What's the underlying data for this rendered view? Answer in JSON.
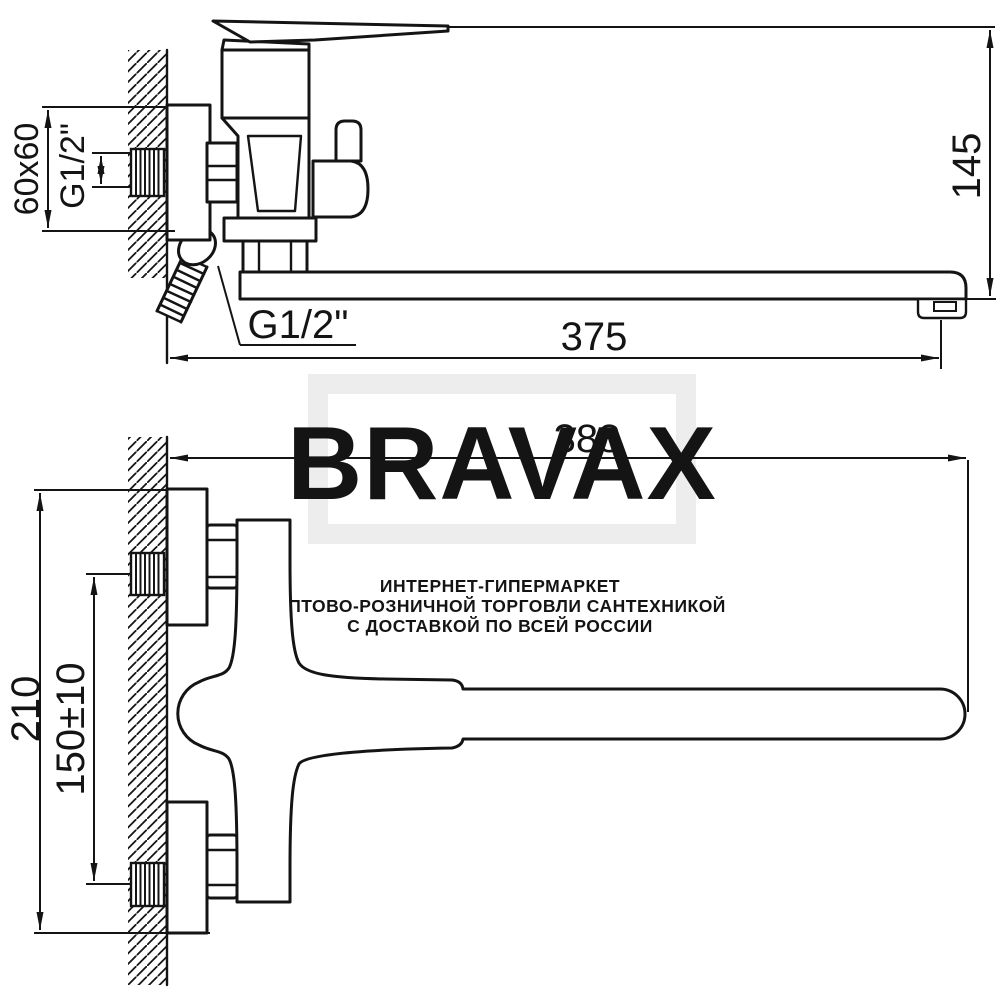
{
  "page": {
    "background": "#ffffff",
    "line_color": "#141414"
  },
  "watermark": {
    "brand": "BRAVAX",
    "brand_color": "#ededed",
    "frame_color": "#ededed",
    "tagline_color": "#e9e9e9",
    "tagline": [
      "ИНТЕРНЕТ-ГИПЕРМАРКЕТ",
      "ОПТОВО-РОЗНИЧНОЙ ТОРГОВЛИ САНТЕХНИКОЙ",
      "С ДОСТАВКОЙ ПО ВСЕЙ РОССИИ"
    ]
  },
  "side_view": {
    "dim_wall_plate": "60x60",
    "dim_inlet_thread": "G1/2\"",
    "dim_height": "145",
    "dim_spout_reach": "375",
    "dim_shower_thread": "G1/2\""
  },
  "front_view": {
    "dim_width": "388",
    "dim_height": "210",
    "dim_inlet_spacing": "150±10"
  }
}
